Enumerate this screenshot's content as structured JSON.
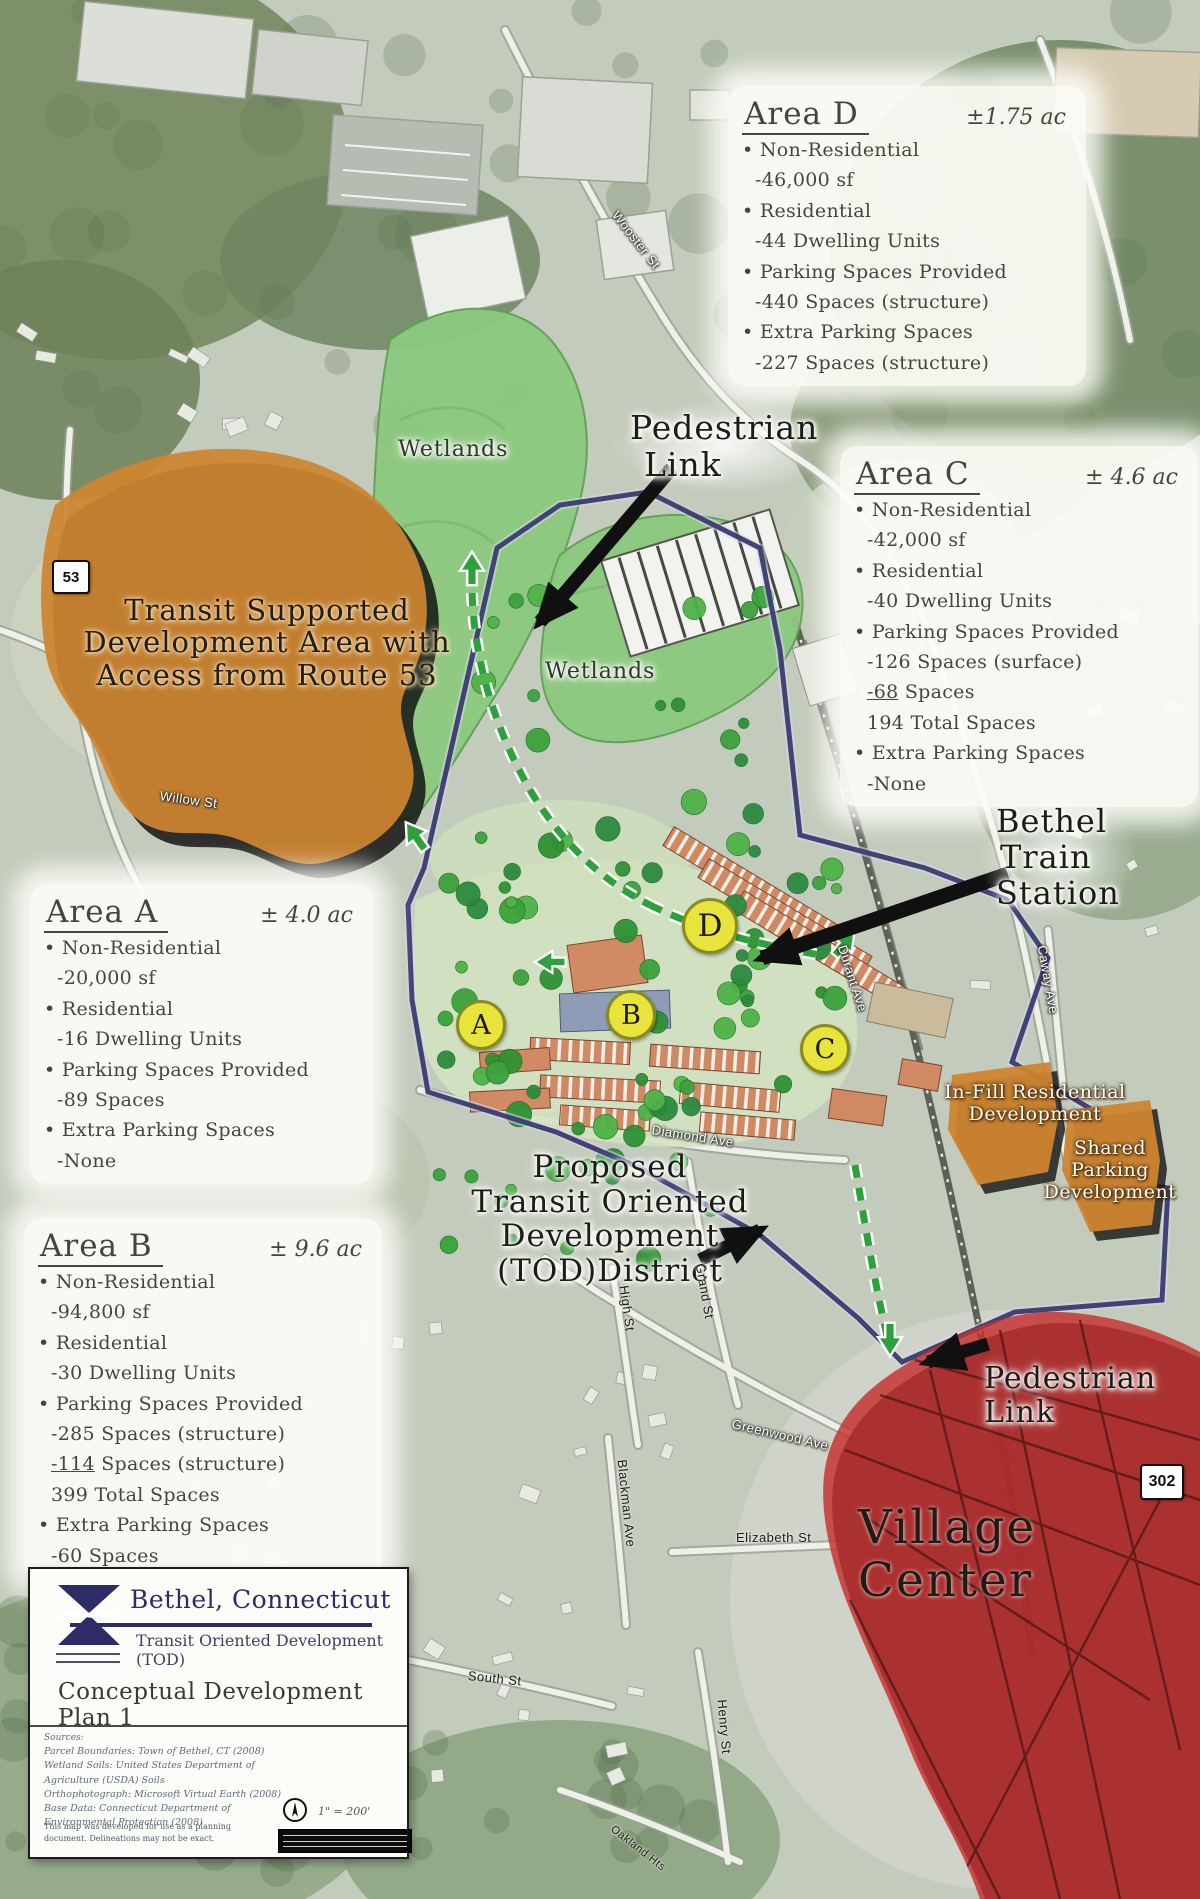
{
  "colors": {
    "transit_area_orange": "#cd8430",
    "village_red": "#c53030",
    "wetland_green": "#8cc97f",
    "tod_boundary_navy": "#3a3b70",
    "marker_yellow": "#e9e43c",
    "pedestrian_path_green": "#2da23c"
  },
  "labels": {
    "ped_top": [
      "Pedestrian",
      "Link"
    ],
    "ped_bottom": [
      "Pedestrian",
      "Link"
    ],
    "station": [
      "Bethel",
      "Train",
      "Station"
    ],
    "tod": [
      "Proposed",
      "Transit Oriented",
      "Development",
      "(TOD)District"
    ],
    "village": "Village Center",
    "transit_supported": [
      "Transit Supported",
      "Development Area with",
      "Access from Route 53"
    ],
    "wetlands_upper": "Wetlands",
    "wetlands_lower": "Wetlands",
    "infill": [
      "In-Fill Residential",
      "Development"
    ],
    "shared": [
      "Shared",
      "Parking",
      "Development"
    ]
  },
  "markers": {
    "a": "A",
    "b": "B",
    "c": "C",
    "d": "D"
  },
  "shields": {
    "s53": "53",
    "s302": "302"
  },
  "streets": {
    "wooster": "Wooster St",
    "willow": "Willow St",
    "diamond": "Diamond Ave",
    "durant": "Durant Ave",
    "caway": "Caway Ave",
    "grand": "Grand St",
    "high": "High St",
    "blackman": "Blackman Ave",
    "greenwood": "Greenwood Ave",
    "elizabeth": "Elizabeth St",
    "south": "South St",
    "henry": "Henry St",
    "oakland": "Oakland Hts"
  },
  "areas": {
    "d": {
      "title": "Area D",
      "acreage": "±1.75 ac",
      "items": [
        {
          "t": "Non-Residential"
        },
        {
          "t": "-46,000 sf"
        },
        {
          "t": "Residential"
        },
        {
          "t": "-44 Dwelling Units"
        },
        {
          "t": "Parking Spaces Provided"
        },
        {
          "t": "-440 Spaces (structure)"
        },
        {
          "t": "Extra Parking Spaces"
        },
        {
          "t": "-227 Spaces (structure)"
        }
      ]
    },
    "c": {
      "title": "Area C",
      "acreage": "± 4.6 ac",
      "items": [
        {
          "t": "Non-Residential"
        },
        {
          "t": "-42,000 sf"
        },
        {
          "t": "Residential"
        },
        {
          "t": "-40 Dwelling Units"
        },
        {
          "t": "Parking Spaces Provided"
        },
        {
          "t": "-126 Spaces (surface)"
        },
        {
          "num": "-68",
          "rest": " Spaces"
        },
        {
          "t": "194 Total Spaces"
        },
        {
          "t": "Extra Parking Spaces"
        },
        {
          "t": "-None"
        }
      ]
    },
    "a": {
      "title": "Area A",
      "acreage": "± 4.0 ac",
      "items": [
        {
          "t": "Non-Residential"
        },
        {
          "t": "-20,000 sf"
        },
        {
          "t": "Residential"
        },
        {
          "t": "-16 Dwelling Units"
        },
        {
          "t": "Parking Spaces Provided"
        },
        {
          "t": "-89 Spaces"
        },
        {
          "t": "Extra Parking Spaces"
        },
        {
          "t": "-None"
        }
      ]
    },
    "b": {
      "title": "Area B",
      "acreage": "± 9.6 ac",
      "items": [
        {
          "t": "Non-Residential"
        },
        {
          "t": "-94,800 sf"
        },
        {
          "t": "Residential"
        },
        {
          "t": "-30 Dwelling Units"
        },
        {
          "t": "Parking Spaces Provided"
        },
        {
          "t": "-285 Spaces (structure)"
        },
        {
          "num": "-114",
          "rest": " Spaces (structure)"
        },
        {
          "t": "399 Total Spaces"
        },
        {
          "t": "Extra Parking Spaces"
        },
        {
          "t": "-60 Spaces"
        }
      ]
    }
  },
  "legend": {
    "town": "Bethel, Connecticut",
    "subtitle": "Transit Oriented Development (TOD)",
    "plan_title": "Conceptual Development Plan 1",
    "sources_heading": "Sources:",
    "sources": [
      "Parcel Boundaries: Town of Bethel, CT (2008)",
      "Wetland Soils: United States Department of",
      "Agriculture (USDA) Soils",
      "Orthophotograph: Microsoft Virtual Earth (2008)",
      "Base Data: Connecticut Department of",
      "Environmental Protection (2008)"
    ],
    "disclaimer": [
      "This map was developed for use as a planning",
      "document. Delineations may not be exact."
    ],
    "scale": "1\" = 200'"
  }
}
